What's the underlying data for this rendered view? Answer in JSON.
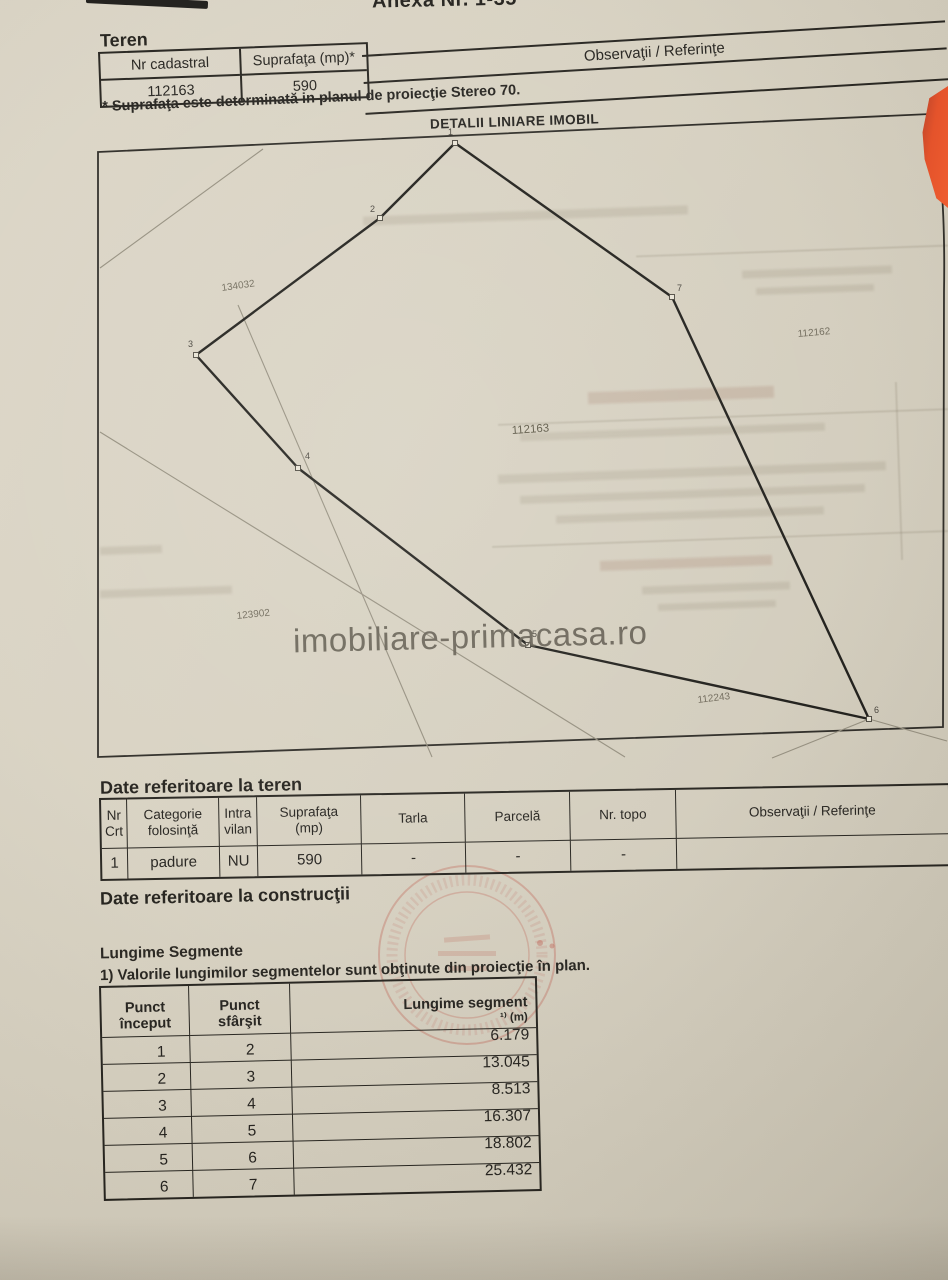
{
  "colors": {
    "paper": "#d6d0c0",
    "ink": "#24221d",
    "edge_orange": "#e0502a",
    "stamp_red": "#b94a3a",
    "watermark_gray": "#6a6455"
  },
  "page_header": {
    "title": "Anexa Nr. 1-35"
  },
  "teren": {
    "heading": "Teren",
    "col_nr_cadastral": "Nr cadastral",
    "col_suprafata": "Suprafaţa (mp)*",
    "col_observatii": "Observaţii / Referinţe",
    "nr_cadastral": "112163",
    "suprafata": "590",
    "footnote": "* Suprafaţa este determinată in planul de proiecţie Stereo 70."
  },
  "diagram": {
    "title": "DETALII LINIARE IMOBIL",
    "watermark": "imobiliare-primacasa.ro",
    "vertices": [
      {
        "n": "1",
        "x": 455,
        "y": 143,
        "lx": 448,
        "ly": 135
      },
      {
        "n": "2",
        "x": 380,
        "y": 218,
        "lx": 370,
        "ly": 212
      },
      {
        "n": "3",
        "x": 196,
        "y": 355,
        "lx": 188,
        "ly": 347
      },
      {
        "n": "4",
        "x": 298,
        "y": 468,
        "lx": 305,
        "ly": 459
      },
      {
        "n": "5",
        "x": 528,
        "y": 645,
        "lx": 532,
        "ly": 637
      },
      {
        "n": "6",
        "x": 869,
        "y": 719,
        "lx": 874,
        "ly": 713
      },
      {
        "n": "7",
        "x": 672,
        "y": 297,
        "lx": 677,
        "ly": 291
      }
    ],
    "parcel_labels": [
      {
        "text": "134032",
        "x": 222,
        "y": 291,
        "r": -8
      },
      {
        "text": "112162",
        "x": 798,
        "y": 337,
        "r": -5
      },
      {
        "text": "112163",
        "x": 512,
        "y": 434,
        "r": -4,
        "big": true
      },
      {
        "text": "123902",
        "x": 237,
        "y": 619,
        "r": -6
      },
      {
        "text": "112243",
        "x": 698,
        "y": 703,
        "r": -7
      }
    ],
    "neighbor_lines": [
      [
        100,
        268,
        263,
        149
      ],
      [
        100,
        432,
        625,
        757
      ],
      [
        238,
        305,
        432,
        757
      ],
      [
        869,
        719,
        947,
        741
      ],
      [
        869,
        719,
        772,
        758
      ]
    ]
  },
  "date_teren": {
    "heading": "Date referitoare la teren",
    "headers": [
      "Nr\nCrt",
      "Categorie\nfolosinţă",
      "Intra\nvilan",
      "Suprafaţa\n(mp)",
      "Tarla",
      "Parcelă",
      "Nr. topo",
      "Observaţii / Referinţe"
    ],
    "row": [
      "1",
      "padure",
      "NU",
      "590",
      "-",
      "-",
      "-",
      ""
    ]
  },
  "date_constructii": {
    "heading": "Date referitoare la construcţii"
  },
  "segments": {
    "heading": "Lungime Segmente",
    "note": "1) Valorile lungimilor segmentelor sunt obţinute din proiecţie în plan.",
    "col_start": "Punct\nînceput",
    "col_end": "Punct\nsfârşit",
    "col_len": "Lungime segment",
    "col_len_unit": "¹⁾ (m)",
    "rows": [
      [
        "1",
        "2",
        "6.179"
      ],
      [
        "2",
        "3",
        "13.045"
      ],
      [
        "3",
        "4",
        "8.513"
      ],
      [
        "4",
        "5",
        "16.307"
      ],
      [
        "5",
        "6",
        "18.802"
      ],
      [
        "6",
        "7",
        "25.432"
      ]
    ]
  }
}
